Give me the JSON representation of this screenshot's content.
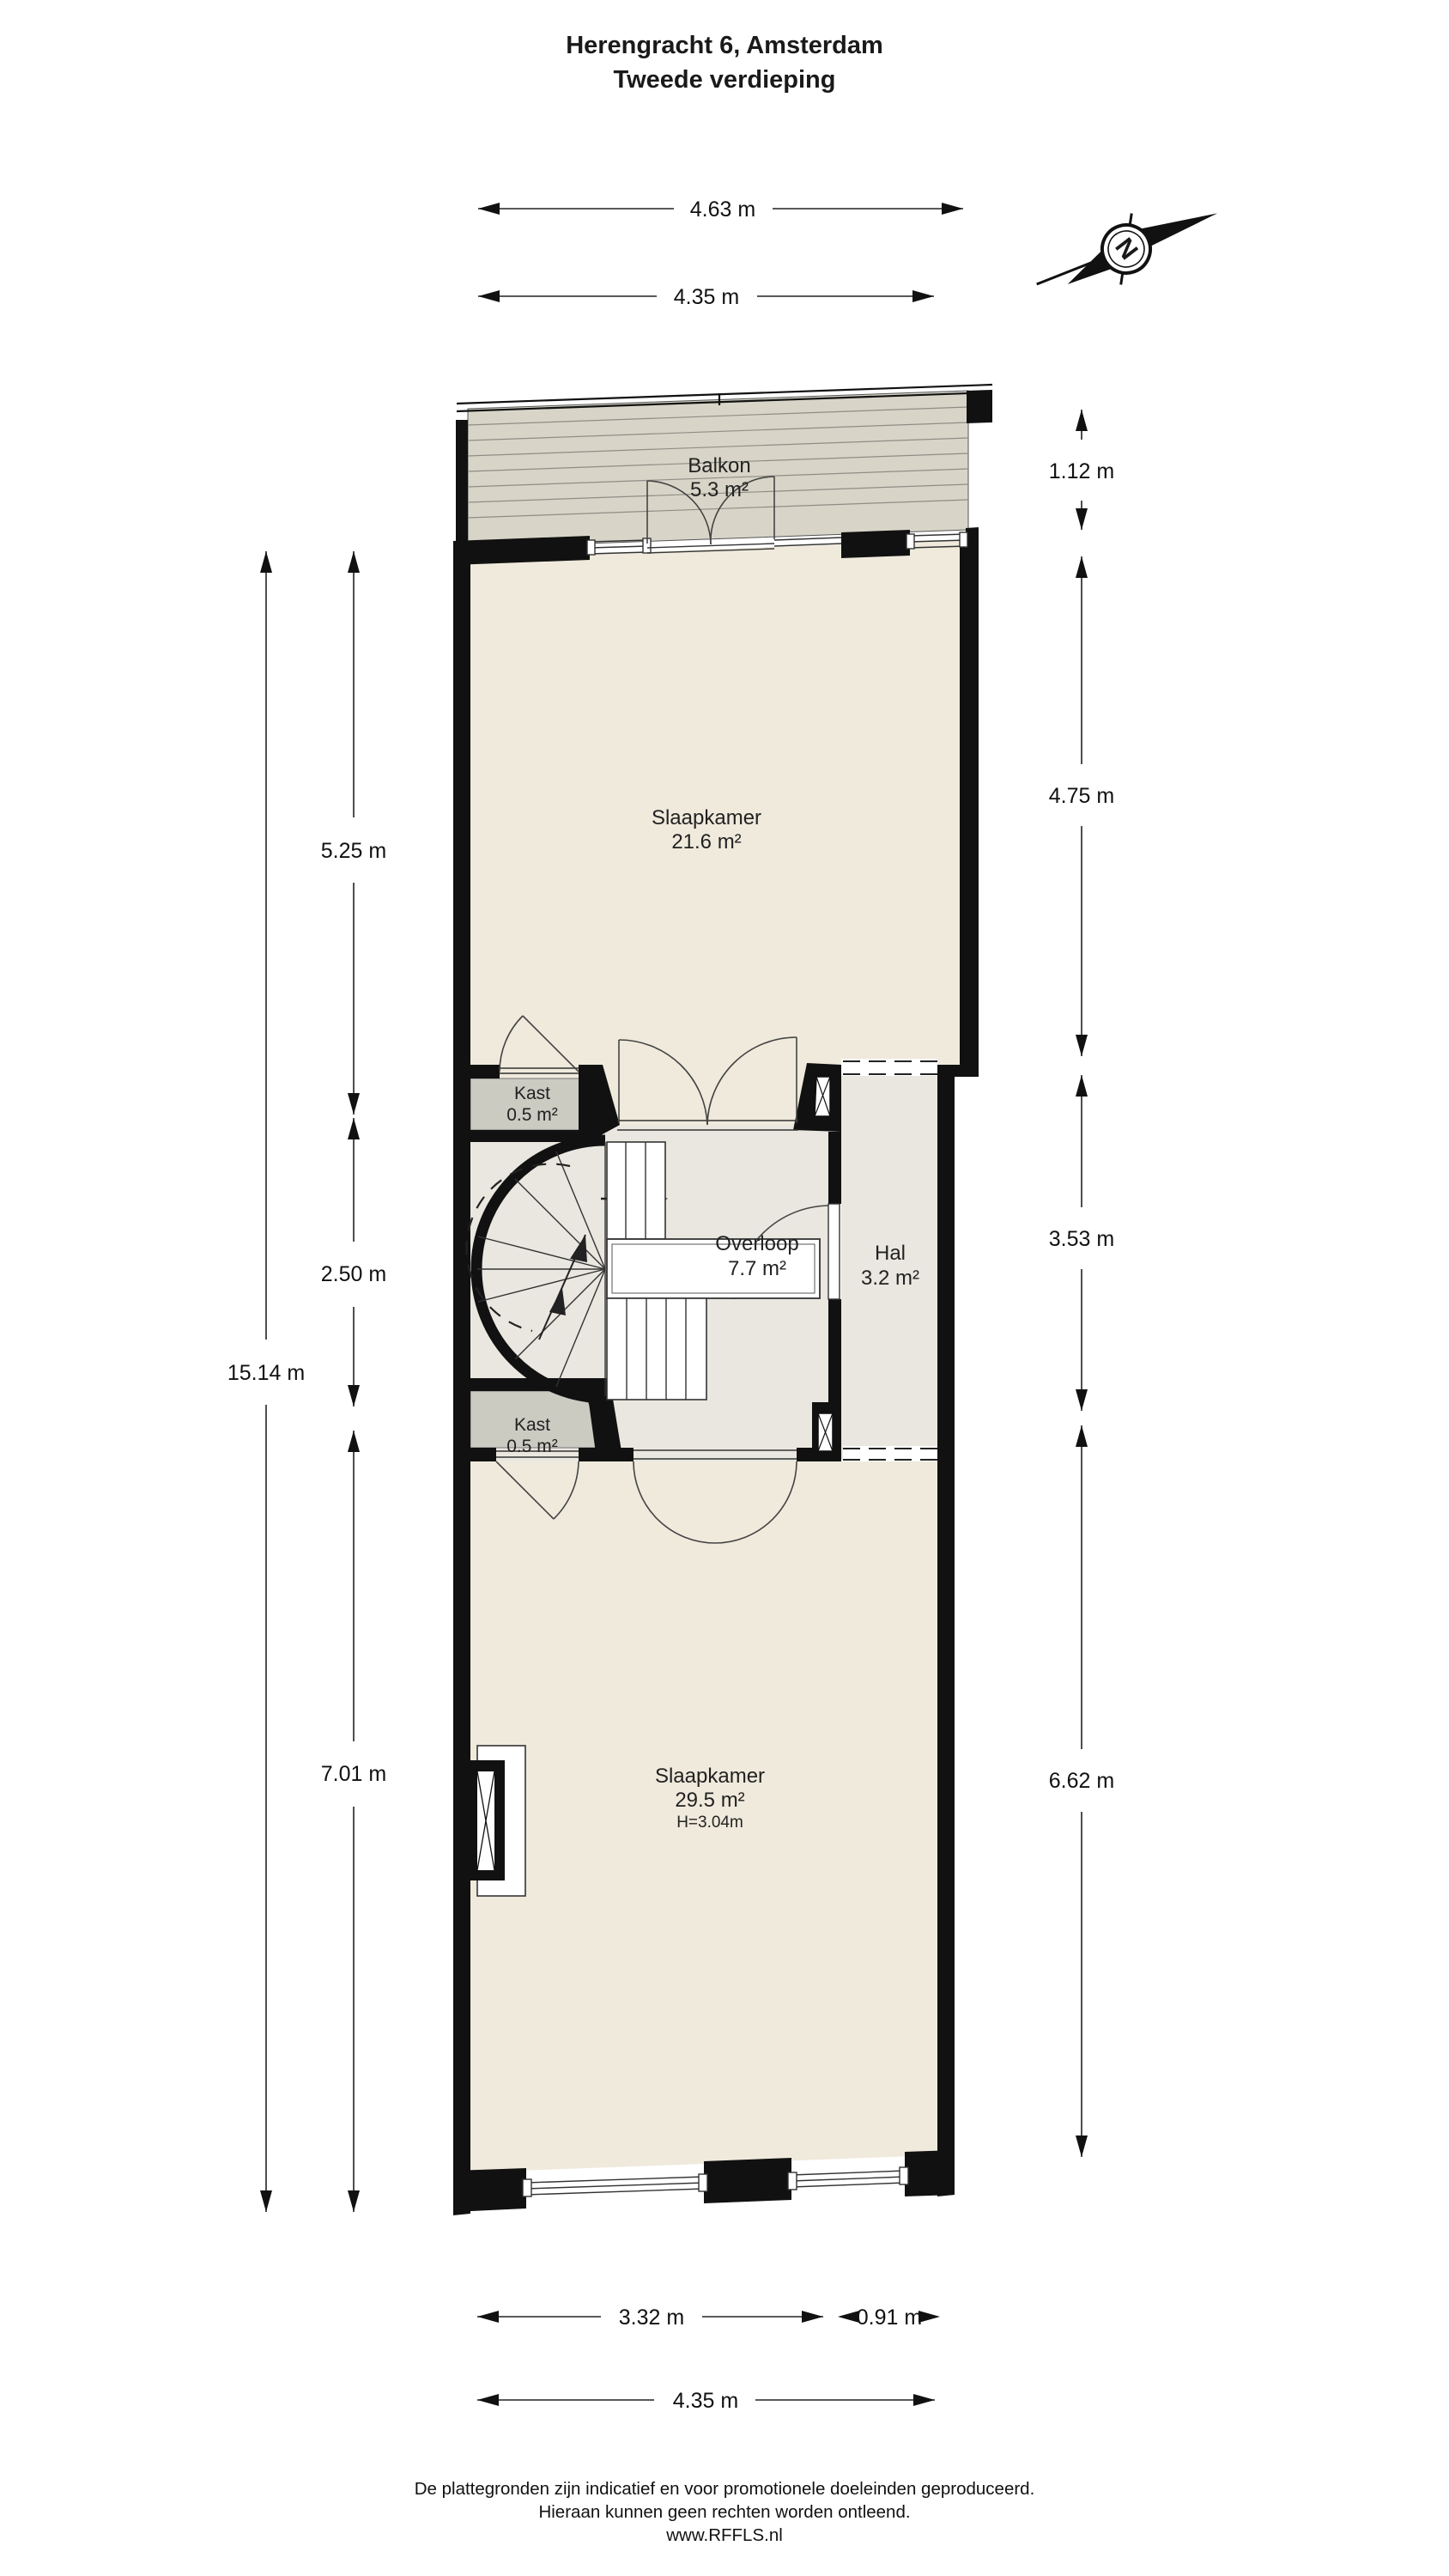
{
  "title": {
    "line1": "Herengracht 6, Amsterdam",
    "line2": "Tweede verdieping"
  },
  "compass": {
    "label": "N"
  },
  "rooms": {
    "balkon": {
      "name": "Balkon",
      "area": "5.3 m²"
    },
    "slaapkamer1": {
      "name": "Slaapkamer",
      "area": "21.6 m²"
    },
    "kast1": {
      "name": "Kast",
      "area": "0.5 m²"
    },
    "overloop": {
      "name": "Overloop",
      "area": "7.7 m²"
    },
    "hal": {
      "name": "Hal",
      "area": "3.2 m²"
    },
    "kast2": {
      "name": "Kast",
      "area": "0.5 m²"
    },
    "slaapkamer2": {
      "name": "Slaapkamer",
      "area": "29.5 m²",
      "height": "H=3.04m"
    }
  },
  "dimensions": {
    "top_outer": "4.63 m",
    "top_inner": "4.35 m",
    "right_balcony": "1.12 m",
    "right_upper": "4.75 m",
    "right_middle": "3.53 m",
    "right_lower": "6.62 m",
    "left_total": "15.14 m",
    "left_upper": "5.25 m",
    "left_middle": "2.50 m",
    "left_lower": "7.01 m",
    "bottom_left": "3.32 m",
    "bottom_right": "0.91 m",
    "bottom_total": "4.35 m"
  },
  "footer": {
    "line1": "De plattegronden zijn indicatief en voor promotionele doeleinden geproduceerd.",
    "line2": "Hieraan kunnen geen rechten worden ontleend.",
    "line3": "www.RFFLS.nl"
  },
  "colors": {
    "wall": "#111111",
    "bedroom_floor": "#efeadc",
    "hall_floor": "#e9e7df",
    "deck": "#d8d5c8",
    "kast_fill": "#cbcbc2"
  }
}
